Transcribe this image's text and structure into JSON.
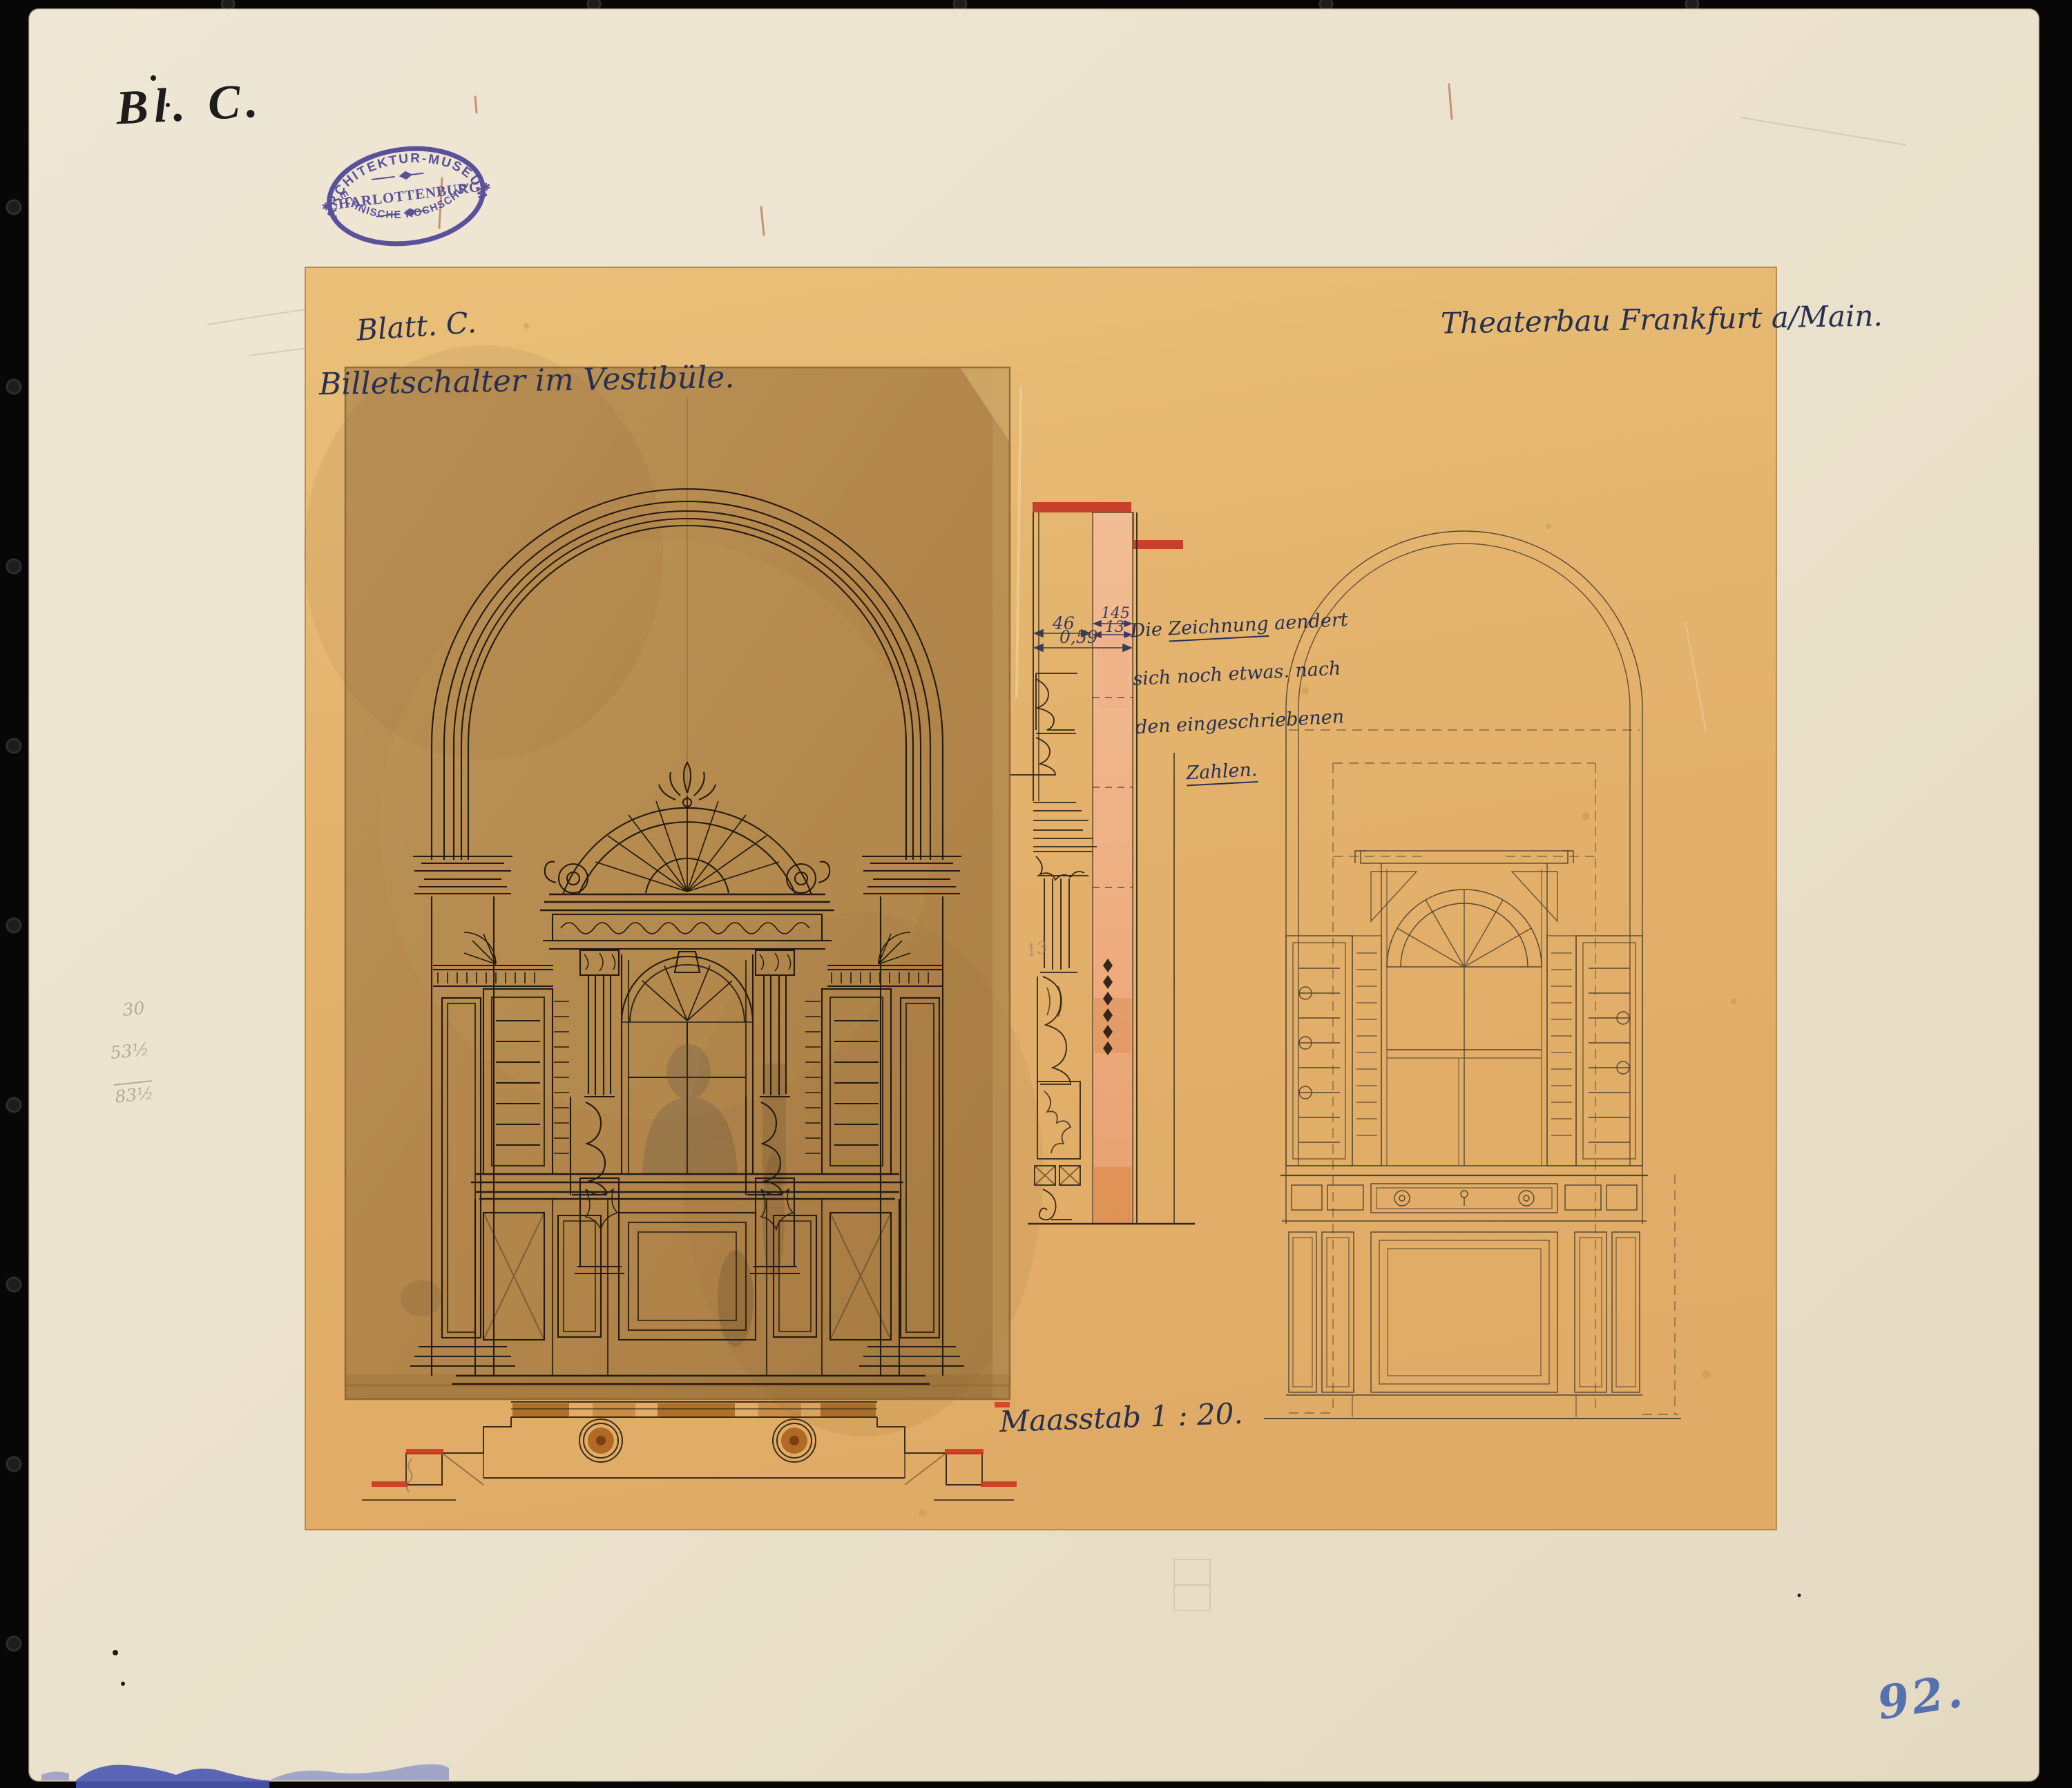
{
  "scan": {
    "corner_label": "Bl. C.",
    "inventory_number": "92."
  },
  "stamp": {
    "arc_top": "ARCHITEKTUR-MUSEUM",
    "middle": "CHARLOTTENBURG.",
    "arc_bottom": "TECHNISCHE HOCHSCHULE.",
    "star": "✱"
  },
  "sheet": {
    "title_line1": "Blatt. C.",
    "title_line2": "Billetschalter im Vestibüle.",
    "project": "Theaterbau Frankfurt a/Main.",
    "scale": "Maasstab 1 : 20."
  },
  "note": {
    "l1a": "Die ",
    "l1b": "Zeichnung",
    "l1c": " aendert",
    "l2": "sich noch etwas. nach",
    "l3": "den eingeschriebenen",
    "l4": "Zahlen."
  },
  "dimensions": {
    "d46": "46",
    "d145": "145",
    "d13": "13",
    "d059": "0,59",
    "pencil_13": "13"
  },
  "pencil_calc": {
    "l1": "30",
    "l2": "53½",
    "sum": "83½"
  },
  "colors": {
    "mount_paper": "#ece3d0",
    "drawing_sheet": "#e5b672",
    "overlay_sheet": "#b3874b",
    "ink": "#241a0e",
    "wash_red": "#c6402c",
    "wash_salmon": "#eeb28b",
    "wash_brown": "#a86a25",
    "stamp_purple": "#453d92",
    "crayon_blue": "#3f63ae"
  }
}
